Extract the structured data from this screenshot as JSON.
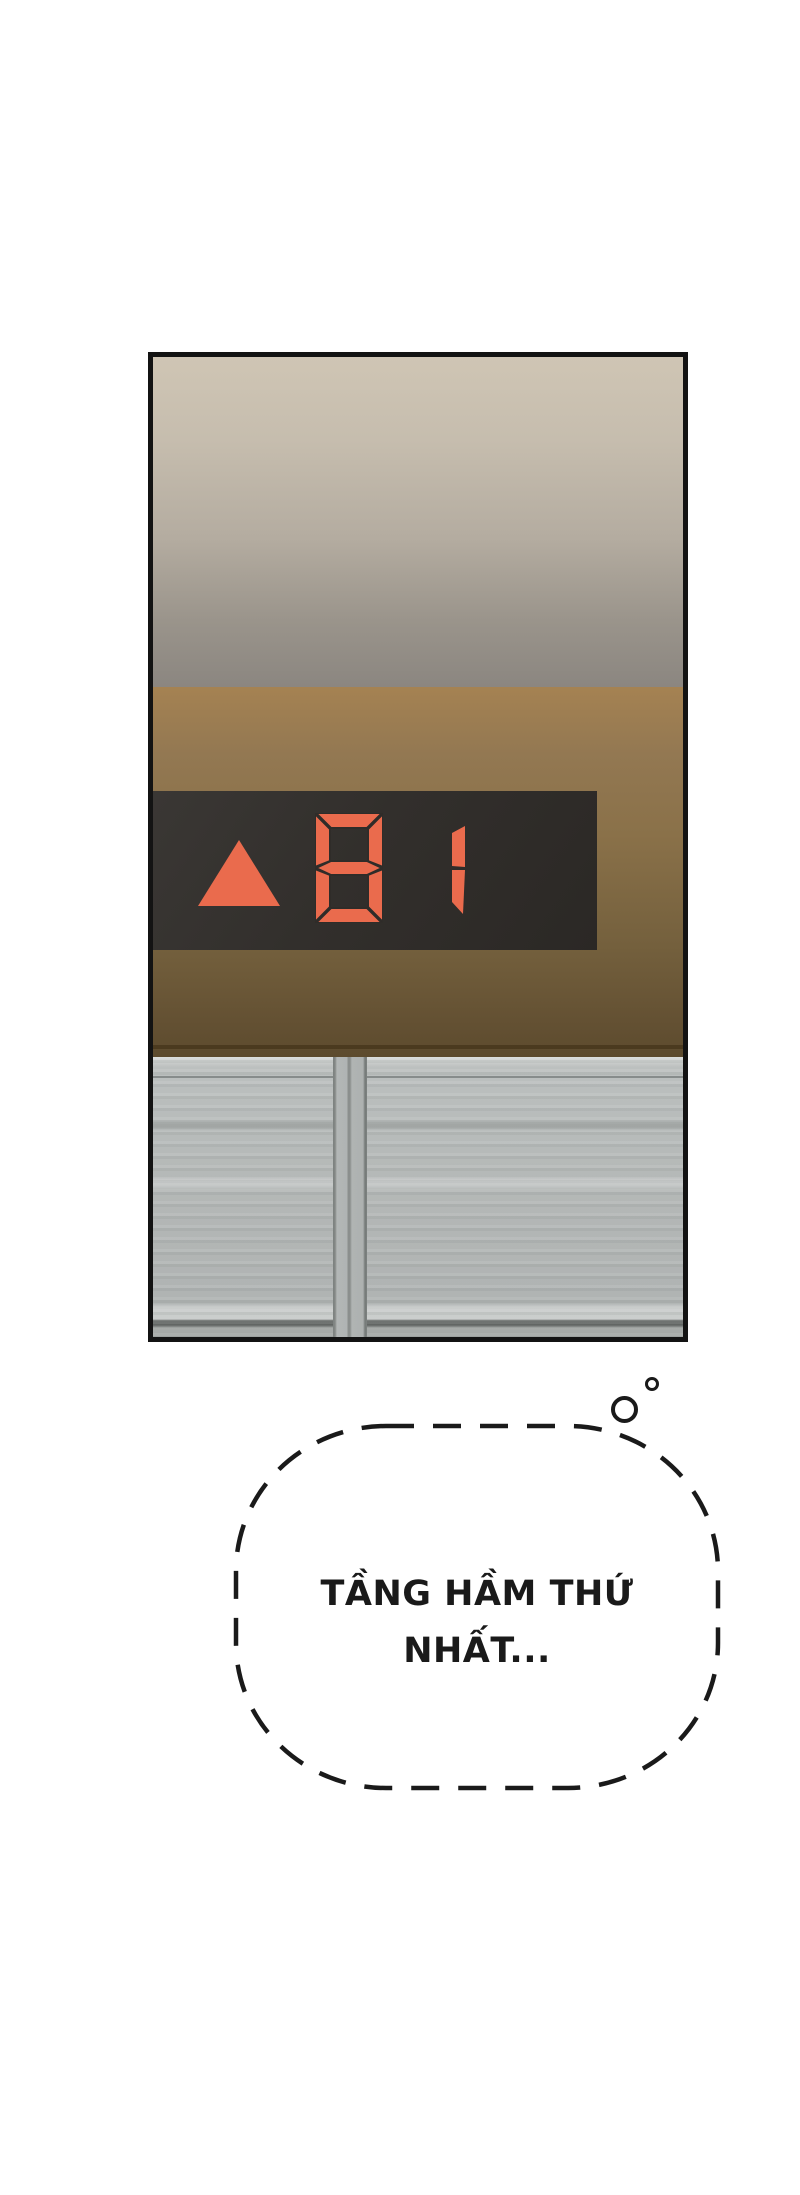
{
  "indicator": {
    "value": "B1",
    "direction_icon": "up-triangle",
    "digits": [
      "B",
      "1"
    ]
  },
  "thought_bubble": {
    "line1": "TẦNG HẦM THỨ",
    "line2": "NHẤT..."
  },
  "colors": {
    "segment-orange": "#ea6b4d",
    "lcd-bg": "#2f2c29",
    "wall-brown": "#8a7149",
    "door-gray": "#b5b9b8",
    "panel-border": "#131313",
    "ink": "#1a1a1a"
  }
}
